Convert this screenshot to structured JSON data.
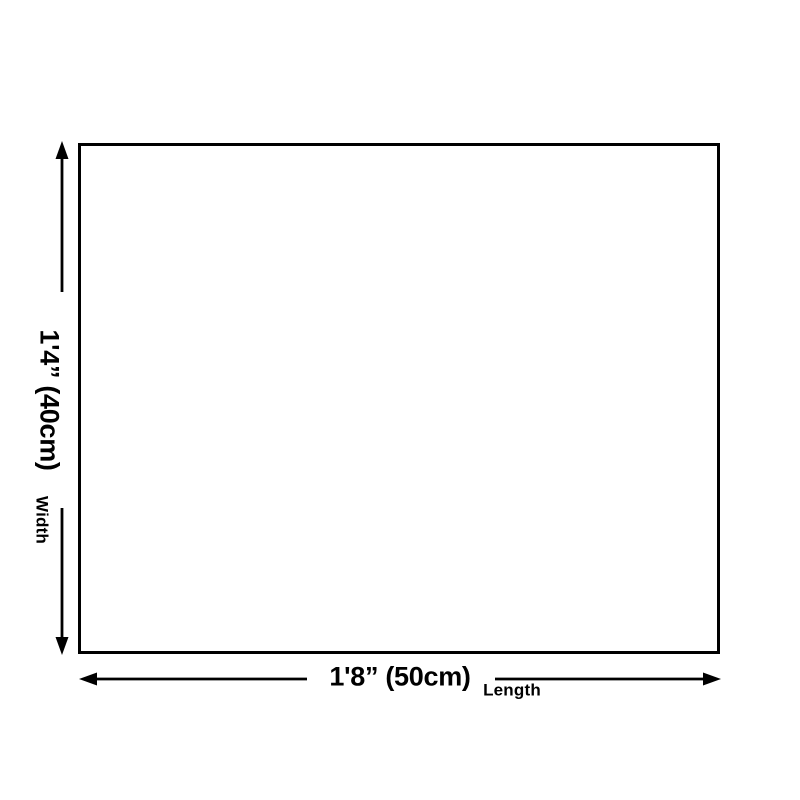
{
  "diagram": {
    "dimensions": {
      "width": {
        "value": "1'4” (40cm)",
        "caption": "Width"
      },
      "length": {
        "value": "1'8” (50cm)",
        "caption": "Length"
      }
    }
  },
  "colors": {
    "line": "#000000",
    "background": "#ffffff",
    "text": "#000000"
  }
}
